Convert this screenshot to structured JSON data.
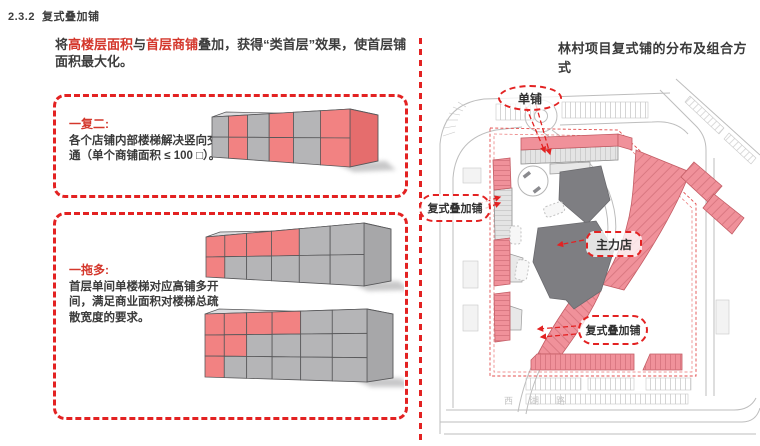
{
  "header": {
    "number": "2.3.2",
    "title": "复式叠加铺"
  },
  "intro": {
    "seg1": "将",
    "hl1": "高楼层面积",
    "seg2": "与",
    "hl2": "首层商铺",
    "seg3": "叠加，获得“类首层”效果，使首层铺面积最大化。"
  },
  "box_one": {
    "heading": "一复二:",
    "body": "各个店铺内部楼梯解决竖向交通（单个商铺面积 ≤ 100 □）。"
  },
  "box_multi": {
    "heading": "一拖多:",
    "body": "首层单间单楼梯对应高铺多开间，满足商业面积对楼梯总疏散宽度的要求。"
  },
  "map": {
    "title": "林村项目复式铺的分布及组合方式",
    "labels": {
      "single": "单铺",
      "duplex_left": "复式叠加铺",
      "anchor": "主力店",
      "duplex_bottom": "复式叠加铺"
    },
    "road_name": "西湖路"
  },
  "colors": {
    "accent": "#e32222",
    "red_text": "#d4372c",
    "red": "#f28282",
    "gray": "#b5b5b7",
    "end_red": "#e56d6d",
    "end_gray": "#a7a7a9",
    "top": "#dddddf",
    "outline": "#58585a",
    "shadow": "#9b9b9d",
    "map_pink": "#f0919a",
    "map_dark": "#7e7e82"
  },
  "diagrams": {
    "one_over_two": {
      "end": "r",
      "pattern": [
        [
          "g",
          "r",
          "g",
          "r",
          "g",
          "r"
        ],
        [
          "g",
          "r",
          "g",
          "r",
          "g",
          "r"
        ]
      ]
    },
    "one_pull_multi_upper": {
      "end": "g",
      "pattern": [
        [
          "r",
          "r",
          "r",
          "r",
          "g",
          "g"
        ],
        [
          "r",
          "g",
          "g",
          "g",
          "g",
          "g"
        ]
      ]
    },
    "one_pull_multi_lower": {
      "end": "g",
      "pattern": [
        [
          "r",
          "r",
          "r",
          "r",
          "g",
          "g"
        ],
        [
          "r",
          "r",
          "g",
          "g",
          "g",
          "g"
        ],
        [
          "r",
          "g",
          "g",
          "g",
          "g",
          "g"
        ]
      ]
    }
  }
}
